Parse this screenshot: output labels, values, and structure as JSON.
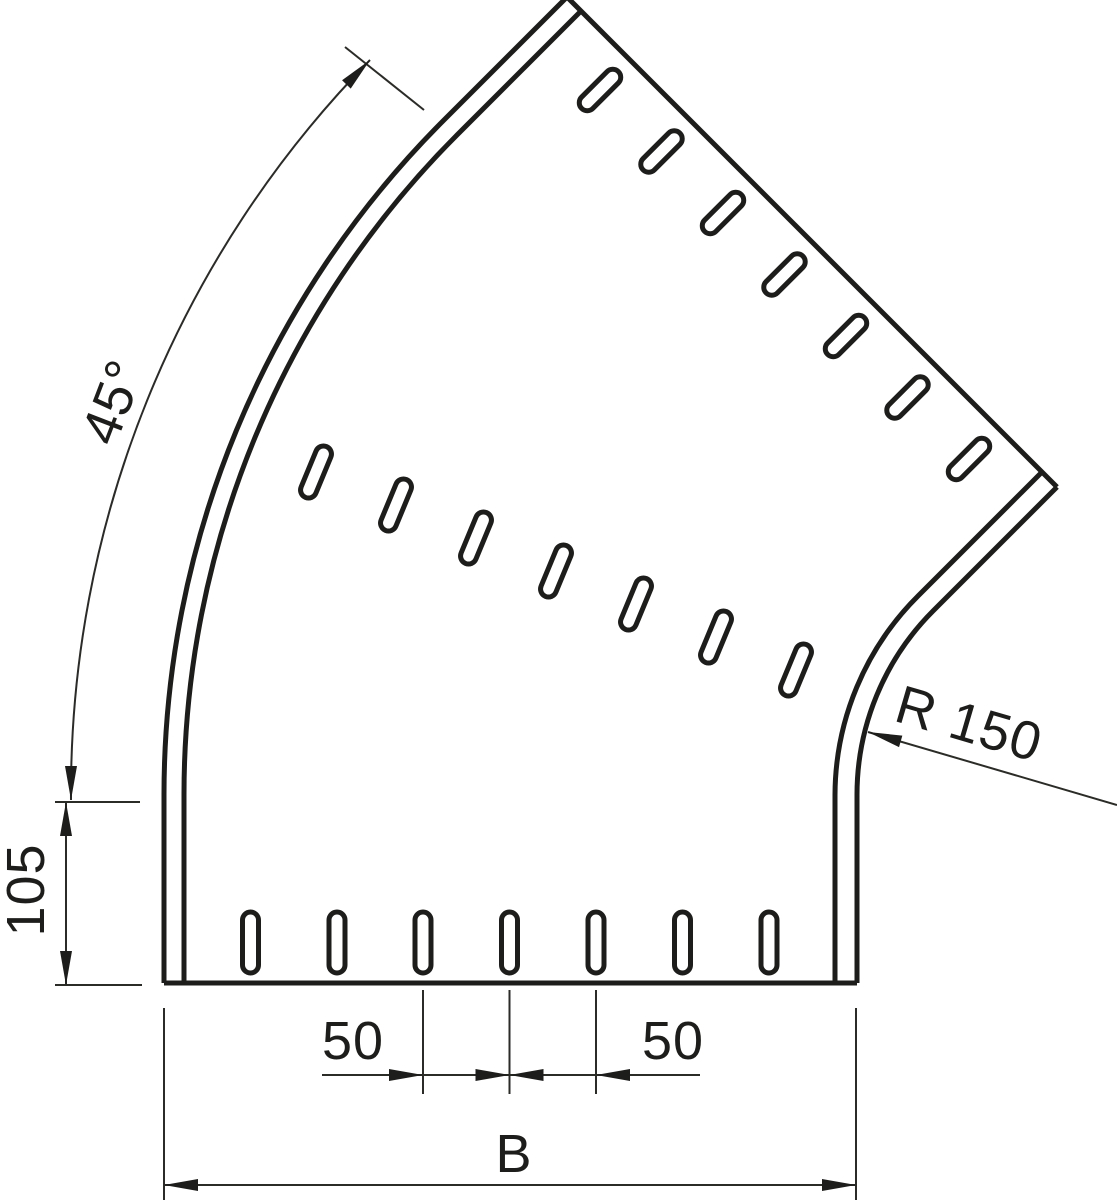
{
  "drawing": {
    "kind": "cable-tray 45-degree flat bend, plan view with perforation slots",
    "labels": {
      "angle": "45°",
      "straight_length": "105",
      "radius": "R 150",
      "pitch_left": "50",
      "pitch_right": "50",
      "overall_width": "B"
    },
    "colors": {
      "line": "#1d1d1b",
      "dimension_line": "#2b2b28",
      "background": "#ffffff"
    }
  }
}
